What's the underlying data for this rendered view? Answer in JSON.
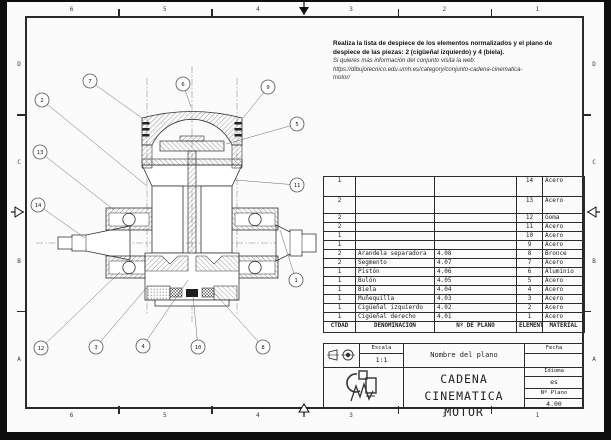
{
  "colors": {
    "paper": "#fbfbfb",
    "ink": "#2a2a2a",
    "background": "#0e0e0e"
  },
  "grid": {
    "top": [
      "6",
      "5",
      "4",
      "3",
      "2",
      "1"
    ],
    "bottom": [
      "6",
      "5",
      "4",
      "3",
      "2",
      "1"
    ],
    "left": [
      "D",
      "C",
      "B",
      "A"
    ],
    "right": [
      "D",
      "C",
      "B",
      "A"
    ]
  },
  "note": {
    "bold_lines": [
      "Realiza la lista de despiece de los elementos normalizados y el plano de",
      "despiece de las piezas: 2 (cigüeñal izquierdo) y 4 (biela)."
    ],
    "italic_lines": [
      "Si quieres más información del conjunto visita la web:",
      "https://dibujotecnico.edu.umh.es/category/conjunto-cadena-cinematica-",
      "motor/"
    ]
  },
  "parts_table": {
    "headers": {
      "qty": "CTDAD",
      "denom": "DENOMINACIÓN",
      "plan": "Nº DE PLANO",
      "elem": "ELEMENTO",
      "mat": "MATERIAL"
    },
    "rows": [
      {
        "qty": "1",
        "denom": "",
        "plan": "",
        "elem": "14",
        "mat": "Acero"
      },
      {
        "qty": "2",
        "denom": "",
        "plan": "",
        "elem": "13",
        "mat": "Acero"
      },
      {
        "qty": "2",
        "denom": "",
        "plan": "",
        "elem": "12",
        "mat": "Goma"
      },
      {
        "qty": "2",
        "denom": "",
        "plan": "",
        "elem": "11",
        "mat": "Acero"
      },
      {
        "qty": "1",
        "denom": "",
        "plan": "",
        "elem": "10",
        "mat": "Acero"
      },
      {
        "qty": "1",
        "denom": "",
        "plan": "",
        "elem": "9",
        "mat": "Acero"
      },
      {
        "qty": "2",
        "denom": "Arandela separadora",
        "plan": "4.08",
        "elem": "8",
        "mat": "Bronce"
      },
      {
        "qty": "2",
        "denom": "Segmento",
        "plan": "4.07",
        "elem": "7",
        "mat": "Acero"
      },
      {
        "qty": "1",
        "denom": "Pistón",
        "plan": "4.06",
        "elem": "6",
        "mat": "Aluminio"
      },
      {
        "qty": "1",
        "denom": "Bulón",
        "plan": "4.05",
        "elem": "5",
        "mat": "Acero"
      },
      {
        "qty": "1",
        "denom": "Biela",
        "plan": "4.04",
        "elem": "4",
        "mat": "Acero"
      },
      {
        "qty": "1",
        "denom": "Muñequilla",
        "plan": "4.03",
        "elem": "3",
        "mat": "Acero"
      },
      {
        "qty": "1",
        "denom": "Cigüeñal izquierdo",
        "plan": "4.02",
        "elem": "2",
        "mat": "Acero"
      },
      {
        "qty": "1",
        "denom": "Cigüeñal derecho",
        "plan": "4.01",
        "elem": "1",
        "mat": "Acero"
      }
    ]
  },
  "title_block": {
    "escala_label": "Escala",
    "escala_value": "1:1",
    "plan_name": "Nombre del plano",
    "fecha_label": "Fecha",
    "fecha_value": "",
    "idioma_label": "Idioma",
    "idioma_value": "es",
    "num_plano_label": "Nº Plano",
    "num_plano_value": "4.00",
    "title_line1": "CADENA CINEMATICA",
    "title_line2": "MOTOR",
    "projection_icon": "first-angle-projection-symbol",
    "logo_icon": "umh-dibujo-tecnico-logo"
  },
  "drawing": {
    "description": "Sectional assembly view of motor kinematic chain: piston, connecting rod, crankshaft, bearings",
    "callouts": [
      {
        "label": "1",
        "x": 266,
        "y": 220,
        "tx": 250,
        "ty": 170
      },
      {
        "label": "2",
        "x": 12,
        "y": 40,
        "tx": 117,
        "ty": 126
      },
      {
        "label": "3",
        "x": 66,
        "y": 287,
        "tx": 118,
        "ty": 226
      },
      {
        "label": "4",
        "x": 113,
        "y": 286,
        "tx": 158,
        "ty": 220
      },
      {
        "label": "5",
        "x": 267,
        "y": 64,
        "tx": 196,
        "ty": 84
      },
      {
        "label": "6",
        "x": 153,
        "y": 24,
        "tx": 161,
        "ty": 47
      },
      {
        "label": "7",
        "x": 60,
        "y": 21,
        "tx": 112,
        "ty": 58
      },
      {
        "label": "8",
        "x": 233,
        "y": 287,
        "tx": 180,
        "ty": 228
      },
      {
        "label": "9",
        "x": 238,
        "y": 27,
        "tx": 213,
        "ty": 58
      },
      {
        "label": "10",
        "x": 168,
        "y": 287,
        "tx": 163,
        "ty": 236
      },
      {
        "label": "11",
        "x": 267,
        "y": 125,
        "tx": 205,
        "ty": 120
      },
      {
        "label": "12",
        "x": 11,
        "y": 288,
        "tx": 90,
        "ty": 212
      },
      {
        "label": "13",
        "x": 10,
        "y": 92,
        "tx": 84,
        "ty": 150
      },
      {
        "label": "14",
        "x": 8,
        "y": 145,
        "tx": 55,
        "ty": 178
      }
    ]
  }
}
